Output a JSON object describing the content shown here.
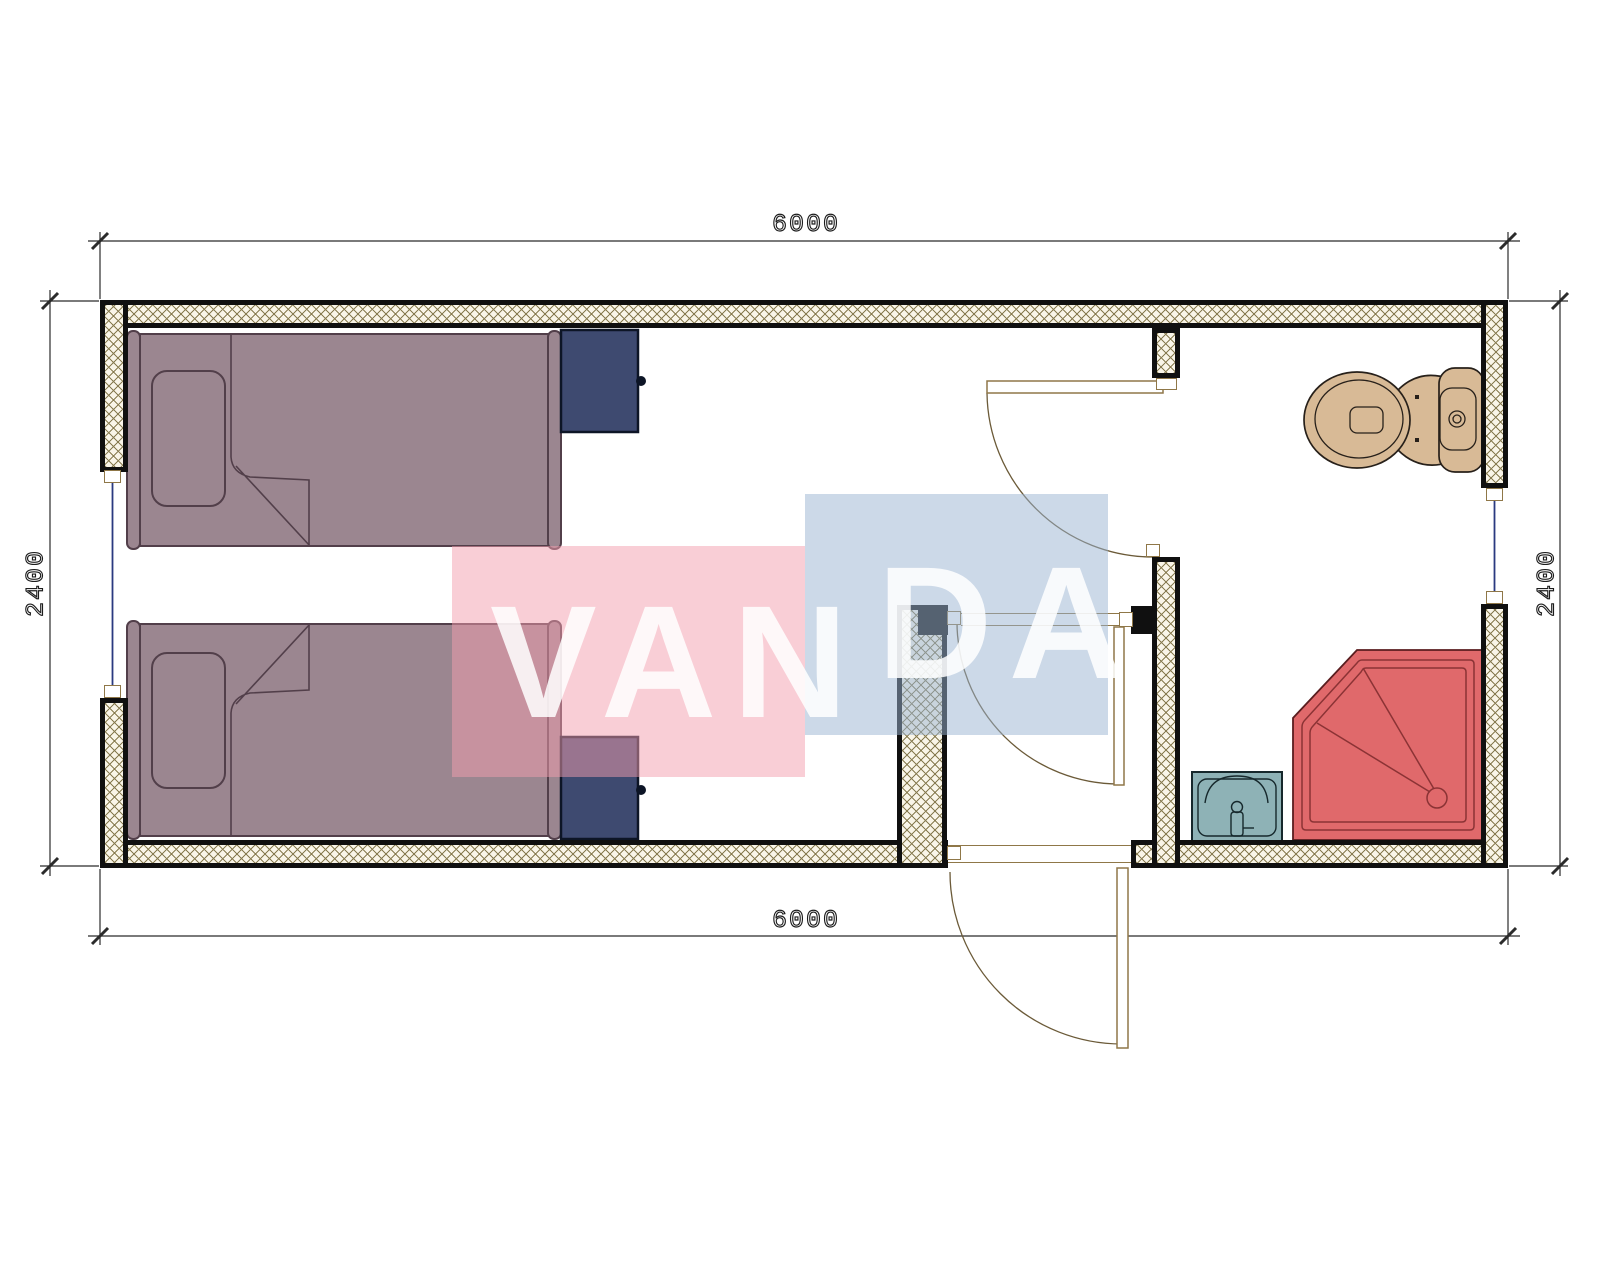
{
  "plan": {
    "type": "architectural-floor-plan",
    "unit_hint": "mm",
    "dimensions": {
      "top": "6000",
      "bottom": "6000",
      "left": "2400",
      "right": "2400"
    },
    "watermark": {
      "text_left": "VAN",
      "text_right": "DA",
      "full_text": "VANDA"
    },
    "fixtures": [
      "bed-upper",
      "bed-lower",
      "nightstand-upper",
      "nightstand-lower",
      "toilet",
      "shower-tray",
      "wash-basin",
      "entrance-door",
      "vestibule-door",
      "bathroom-door",
      "window-left",
      "window-right"
    ],
    "rooms": [
      "bedroom",
      "entry-vestibule",
      "bathroom"
    ]
  },
  "colors": {
    "ink": "#101010",
    "hatch-bg": "#f9f5e8",
    "hatch-line": "#877b50",
    "dim": "#2b2b2b",
    "bed-fill": "#9b8690",
    "bed-stroke": "#523f4a",
    "ns-fill": "#3e4a70",
    "ns-stroke": "#0d1526",
    "toilet-fill": "#d8ba96",
    "toilet-stroke": "#27201a",
    "shower-fill": "#e0696b",
    "shower-stroke": "#5a1d1f",
    "shower-line": "#8b3335",
    "sink-fill": "#8eb2b6",
    "sink-stroke": "#16282c",
    "door-frame": "#8f7748",
    "door-arc": "#6b5a38",
    "glass": "#2a3a80",
    "wm-pink": "rgba(243,157,173,0.5)",
    "wm-blue": "rgba(153,179,209,0.5)",
    "wm-text": "rgba(255,255,255,0.85)"
  }
}
